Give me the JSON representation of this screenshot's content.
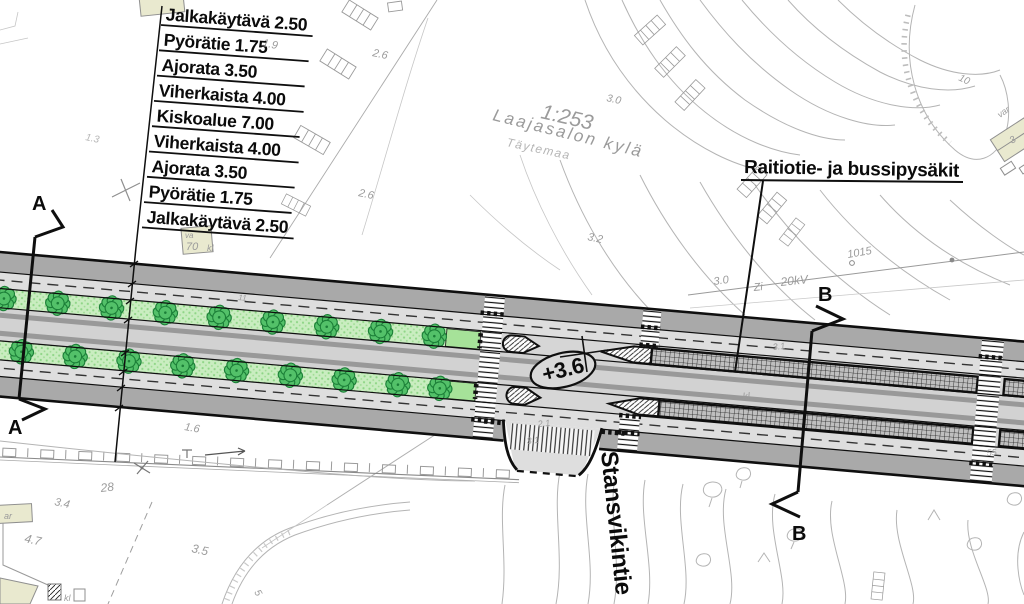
{
  "plan": {
    "cross_section_labels": [
      "Jalkakäytävä 2.50",
      "Pyörätie 1.75",
      "Ajorata 3.50",
      "Viherkaista 4.00",
      "Kiskoalue 7.00",
      "Viherkaista 4.00",
      "Ajorata 3.50",
      "Pyörätie 1.75",
      "Jalkakäytävä 2.50"
    ],
    "stops_label": "Raitiotie- ja bussipysäkit",
    "street_name": "Stansvikintie",
    "district_name": "Laajasalon kylä",
    "fill_area_label": "Täytemaa",
    "parcel_id": "1:253",
    "level_marker": "+3.6",
    "section_markers": {
      "a": "A",
      "b": "B"
    },
    "power_line": {
      "prefix": "Zi",
      "voltage": "20kV",
      "pole_id": "1015"
    },
    "buildings": {
      "va": "va",
      "seventy": "70",
      "kl": "kl",
      "ar": "ar",
      "kl2": "kl"
    },
    "dims": {
      "d21": "2.1",
      "d31a": "3.1",
      "d31b": "3.1",
      "dkl": "kl"
    },
    "spot_heights": {
      "h19": "1.9",
      "h26a": "2.6",
      "h26b": "2.6",
      "h13": "1.3",
      "h30a": "3.0",
      "h32": "3.2",
      "h30b": "3.0",
      "h16": "1.6",
      "h28": "28",
      "h34": "3.4",
      "h47": "4.7",
      "h35": "3.5",
      "h10": "10",
      "h3": "3",
      "h5": "5",
      "h55": "55",
      "h11": "11",
      "hvar": "var"
    },
    "colors": {
      "sidewalk_band": "#a9a9a9",
      "roadway": "#dedede",
      "track_zone": "#d2d2d2",
      "median_green": "#c9edc0",
      "tree_green": "#53c169",
      "building_beige": "#e9e9cf"
    }
  }
}
